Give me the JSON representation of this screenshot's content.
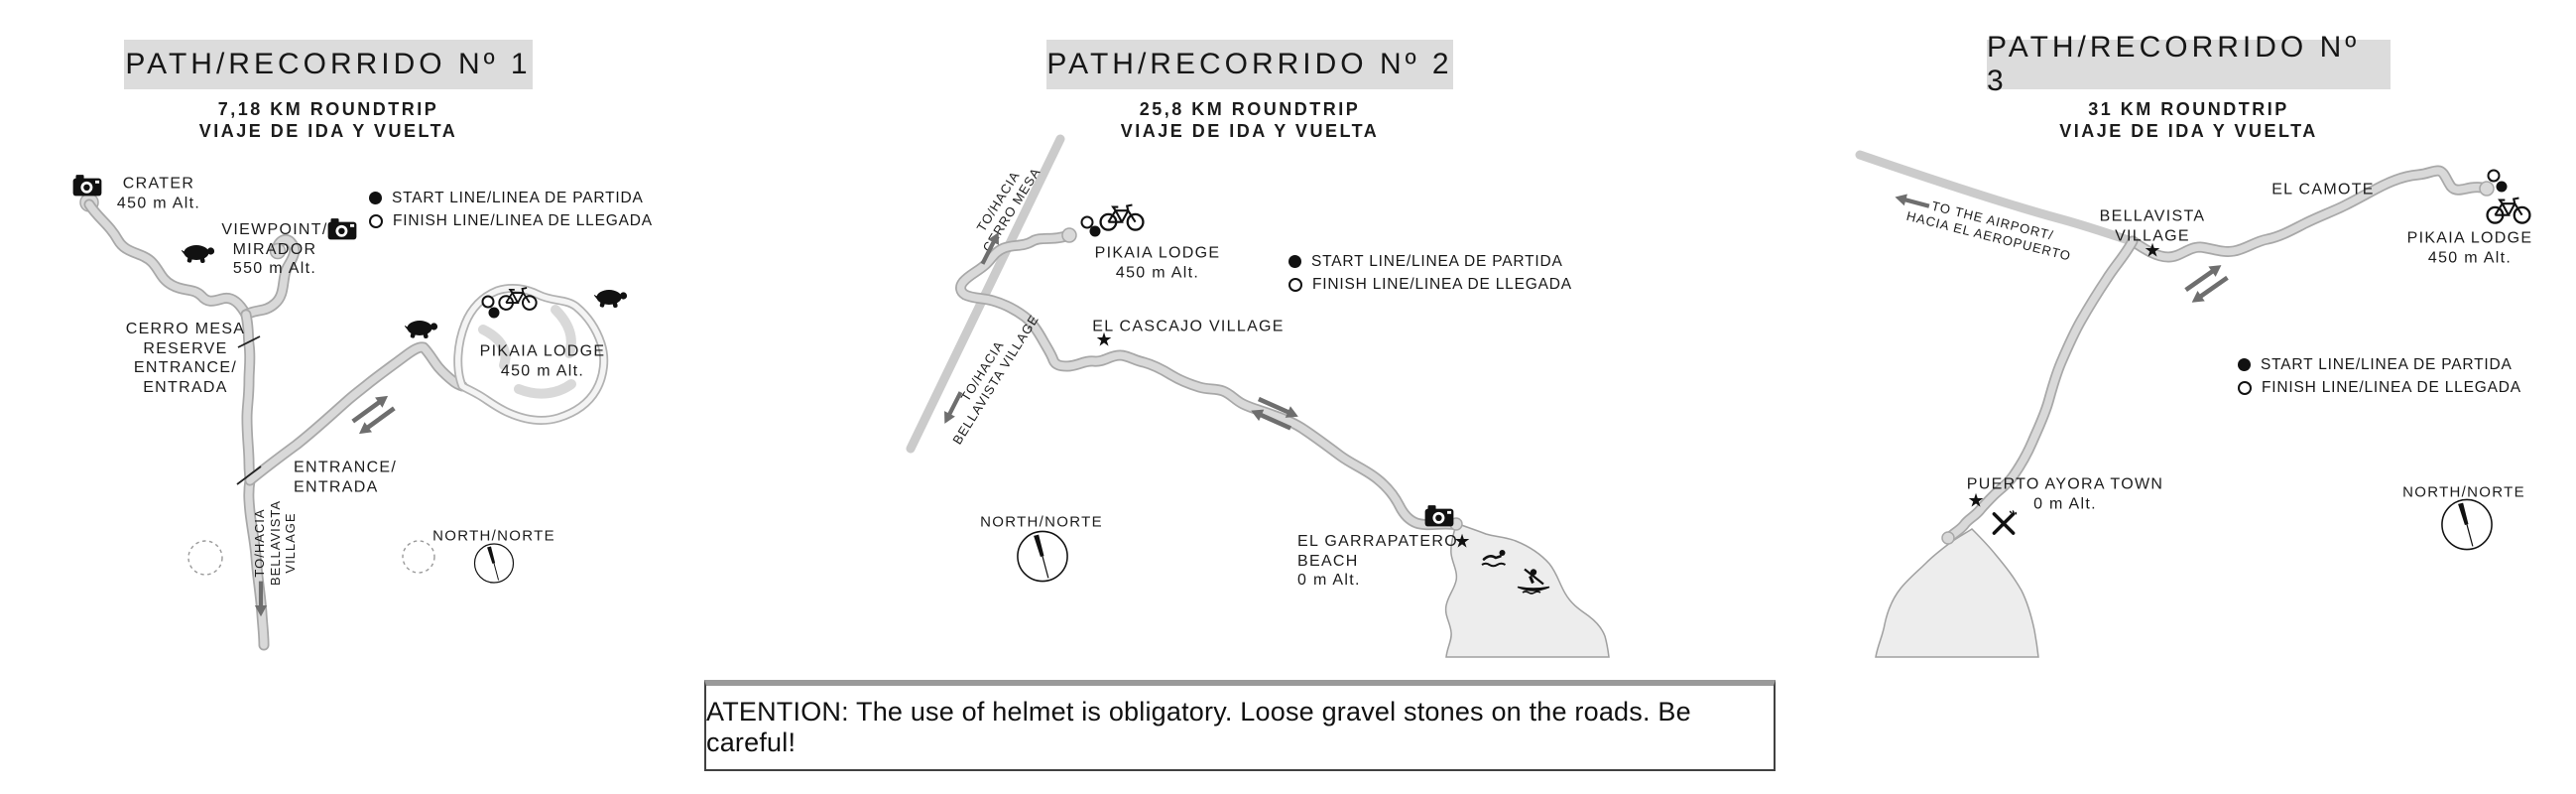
{
  "legend": {
    "start": "START LINE/LINEA DE PARTIDA",
    "finish": "FINISH LINE/LINEA DE LLEGADA"
  },
  "north_label": "NORTH/NORTE",
  "glyphs": {
    "star": "★"
  },
  "panels": [
    {
      "title": "PATH/RECORRIDO Nº 1",
      "subtitle1": "7,18 KM ROUNDTRIP",
      "subtitle2": "VIAJE DE IDA Y VUELTA",
      "labels": {
        "crater": [
          "CRATER",
          "450 m Alt."
        ],
        "viewpoint": [
          "VIEWPOINT/",
          "MIRADOR",
          "550 m Alt."
        ],
        "reserve": [
          "CERRO MESA",
          "RESERVE",
          "ENTRANCE/",
          "ENTRADA"
        ],
        "lodge": [
          "PIKAIA LODGE",
          "450 m Alt."
        ],
        "entrance": [
          "ENTRANCE/",
          "ENTRADA"
        ],
        "to_bellavista": [
          "TO/HACIA",
          "BELLAVISTA",
          "VILLAGE"
        ]
      }
    },
    {
      "title": "PATH/RECORRIDO Nº 2",
      "subtitle1": "25,8 KM ROUNDTRIP",
      "subtitle2": "VIAJE DE IDA Y VUELTA",
      "labels": {
        "to_cerro_mesa": [
          "TO/HACIA",
          "CERRO MESA"
        ],
        "lodge": [
          "PIKAIA LODGE",
          "450 m Alt."
        ],
        "cascajo": "EL CASCAJO VILLAGE",
        "to_bellavista": [
          "TO/HACIA",
          "BELLAVISTA VILLAGE"
        ],
        "beach": [
          "EL GARRAPATERO",
          "BEACH",
          "0 m Alt."
        ]
      }
    },
    {
      "title": "PATH/RECORRIDO Nº 3",
      "subtitle1": "31 KM ROUNDTRIP",
      "subtitle2": "VIAJE DE IDA Y VUELTA",
      "labels": {
        "airport": [
          "TO THE AIRPORT/",
          "HACIA EL AEROPUERTO"
        ],
        "bellavista": [
          "BELLAVISTA",
          "VILLAGE"
        ],
        "camote": "EL CAMOTE",
        "lodge": [
          "PIKAIA LODGE",
          "450 m Alt."
        ],
        "puerto": [
          "PUERTO AYORA TOWN",
          "0 m Alt."
        ]
      }
    }
  ],
  "attention": "ATENTION: The use of helmet is obligatory. Loose gravel stones on the roads. Be careful!"
}
